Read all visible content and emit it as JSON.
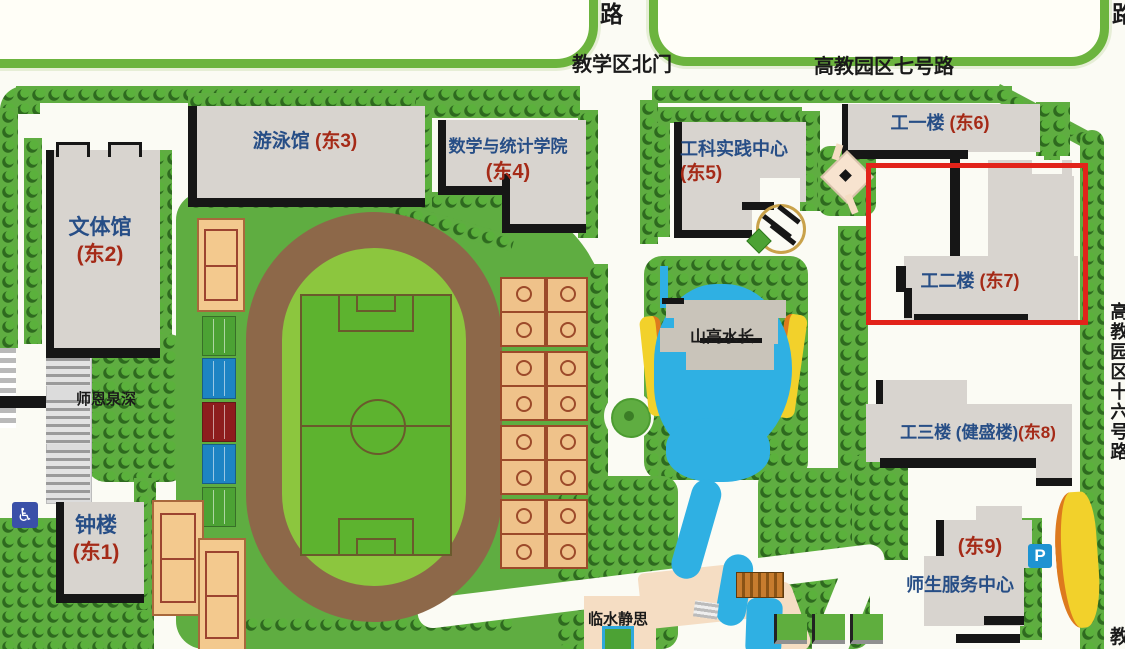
{
  "roads": {
    "top_left_label": "路",
    "top_right_label": "路",
    "north_gate": "教学区北门",
    "road_seven": "高教园区七号路",
    "road_sixteen_vertical": "高教园区十六号路",
    "bottom_right_partial": "教"
  },
  "buildings": {
    "east1": {
      "name": "钟楼",
      "tag": "(东1)"
    },
    "east2": {
      "name": "文体馆",
      "tag": "(东2)"
    },
    "east3": {
      "name": "游泳馆",
      "tag": "(东3)"
    },
    "east4": {
      "name": "数学与统计学院",
      "tag": "(东4)"
    },
    "east5": {
      "name": "工科实践中心",
      "tag": "(东5)"
    },
    "east6": {
      "name": "工一楼",
      "tag": "(东6)"
    },
    "east7": {
      "name": "工二楼",
      "tag": "(东7)"
    },
    "east8": {
      "name": "工三楼 (健盛楼)",
      "tag": "(东8)"
    },
    "east9": {
      "name": "师生服务中心",
      "tag": "(东9)"
    }
  },
  "landmarks": {
    "pond": "山高水长",
    "spring": "师恩泉深",
    "stream": "临水静思"
  },
  "icons": {
    "parking_label": "P",
    "accessibility_symbol": "♿"
  },
  "highlight_color": "#e2231a",
  "colors": {
    "grass": "#5fad41",
    "track": "#8d6849",
    "field": "#8cc63e",
    "pitch": "#5db32f",
    "water": "#2fb0e3",
    "building_fill": "#d8d4cf",
    "building_shadow": "#161616",
    "court_tan": "#efc28a",
    "court_blue": "#1d84c4",
    "court_red": "#8d1d1d",
    "path_cream": "#f5ddc3",
    "label_blue": "#274e86",
    "label_red": "#a52a17",
    "road_border_green": "#6cb43e"
  }
}
